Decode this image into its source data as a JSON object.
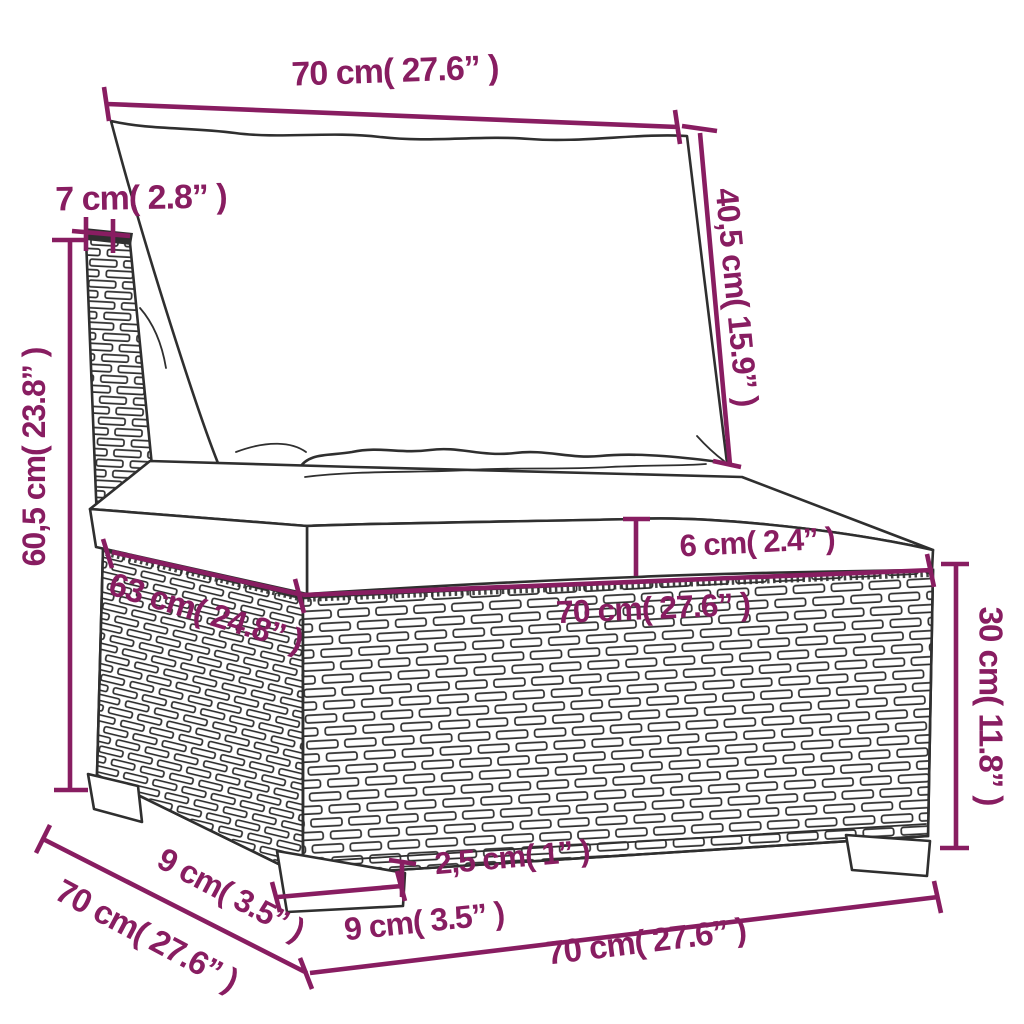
{
  "colors": {
    "accent": "#881d61",
    "outline": "#2f2f2f",
    "background": "#ffffff"
  },
  "diagram": {
    "type": "product-dimensions",
    "subject": "rattan-sofa-section-with-cushions",
    "labels": {
      "top_width": "70 cm( 27.6” )",
      "post_top_width": "7 cm( 2.8” )",
      "back_cushion_height": "40,5 cm( 15.9” )",
      "total_height": "60,5 cm( 23.8” )",
      "seat_depth": "63 cm( 24.8” )",
      "seat_cushion_thickness": "6 cm( 2.4” )",
      "seat_width": "70 cm( 27.6” )",
      "base_height": "30 cm( 11.8” )",
      "leg_inset": "2,5 cm( 1” )",
      "leg_width": "9 cm( 3.5” )",
      "leg_depth": "9 cm( 3.5” )",
      "side_depth": "70 cm( 27.6” )",
      "bottom_width": "70 cm( 27.6” )"
    }
  }
}
